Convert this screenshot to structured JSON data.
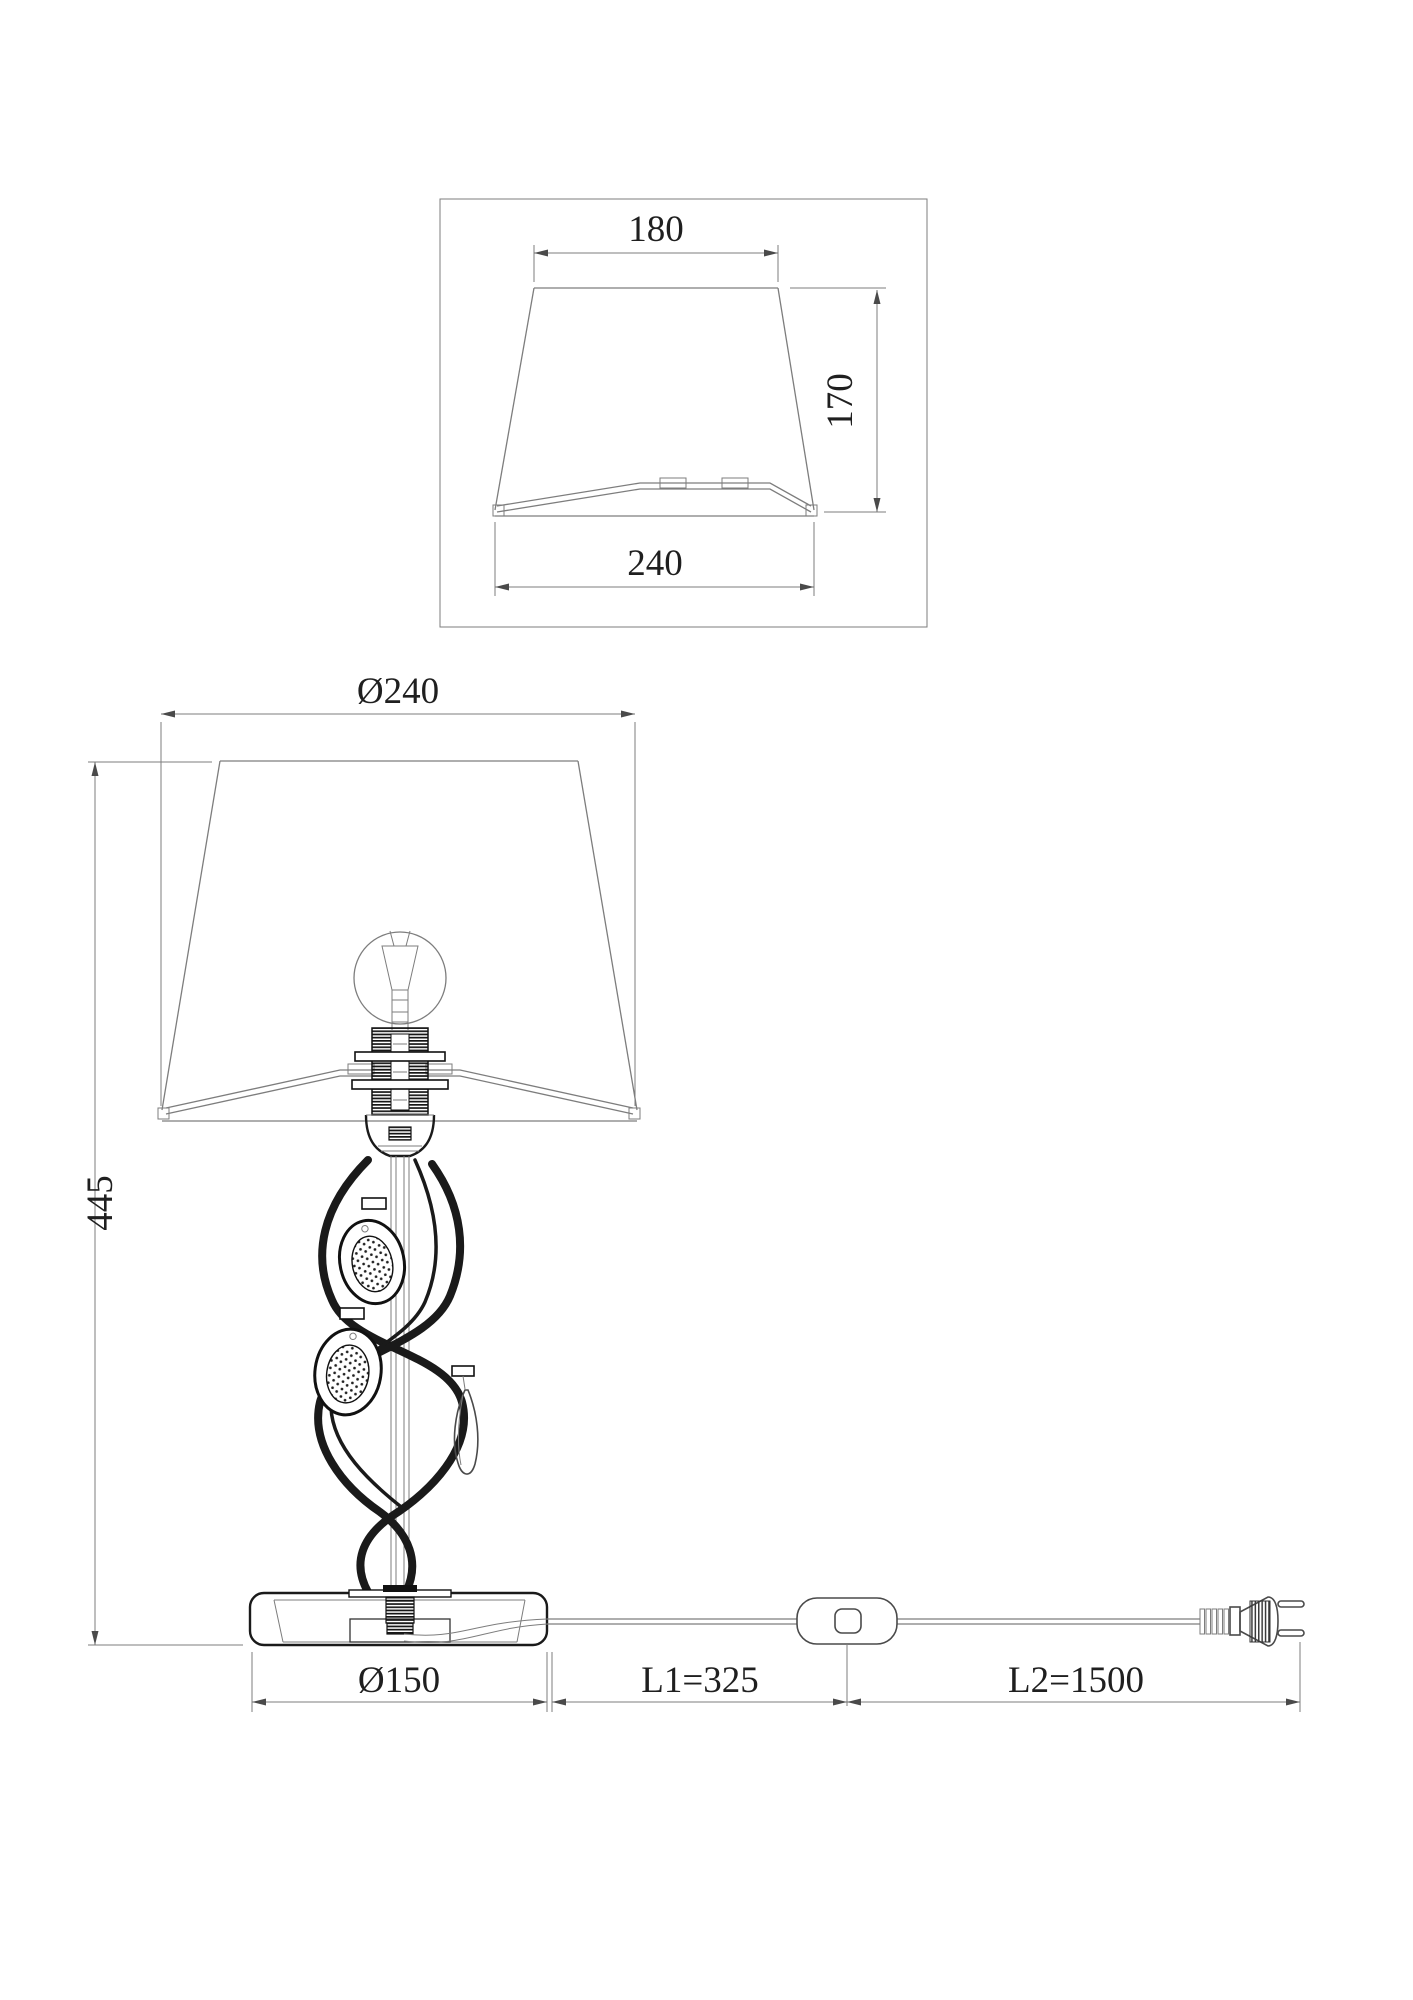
{
  "top_view": {
    "top_width": "180",
    "bottom_width": "240",
    "height": "170"
  },
  "front_view": {
    "shade_diameter": "Ø240",
    "total_height": "445",
    "base_diameter": "Ø150",
    "cord_length_1": "L1=325",
    "cord_length_2": "L2=1500"
  },
  "colors": {
    "background": "#ffffff",
    "construction_line": "#7d7d7d",
    "feature_line": "#1a1a1a",
    "dimension_text": "#1f1f1f"
  }
}
